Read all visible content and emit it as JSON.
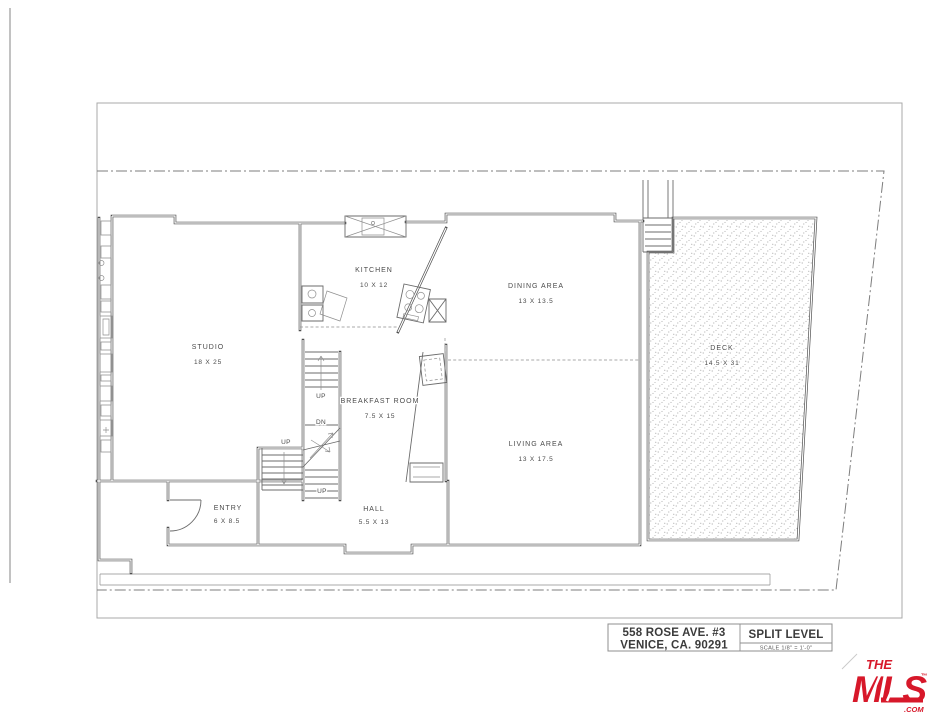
{
  "title_block": {
    "address_line1": "558 ROSE AVE. #3",
    "address_line2": "VENICE, CA. 90291",
    "plan_type": "SPLIT LEVEL",
    "scale_note": "SCALE 1/8\" = 1'-0\""
  },
  "logo": {
    "the": "THE",
    "mls": "MLS",
    "com": ".COM",
    "tm": "™",
    "color": "#d7182a"
  },
  "rooms": {
    "studio": {
      "name": "STUDIO",
      "dims": "18 X 25"
    },
    "kitchen": {
      "name": "KITCHEN",
      "dims": "10 X 12"
    },
    "dining": {
      "name": "DINING AREA",
      "dims": "13 X 13.5"
    },
    "breakfast": {
      "name": "BREAKFAST ROOM",
      "dims": "7.5 X 15"
    },
    "living": {
      "name": "LIVING AREA",
      "dims": "13 X 17.5"
    },
    "deck": {
      "name": "DECK",
      "dims": "14.5 X 31"
    },
    "entry": {
      "name": "ENTRY",
      "dims": "6 X 8.5"
    },
    "hall": {
      "name": "HALL",
      "dims": "5.5 X 13"
    }
  },
  "stair_labels": {
    "up_top": "UP",
    "dn": "DN",
    "up_left": "UP",
    "up_bottom": "UP"
  }
}
